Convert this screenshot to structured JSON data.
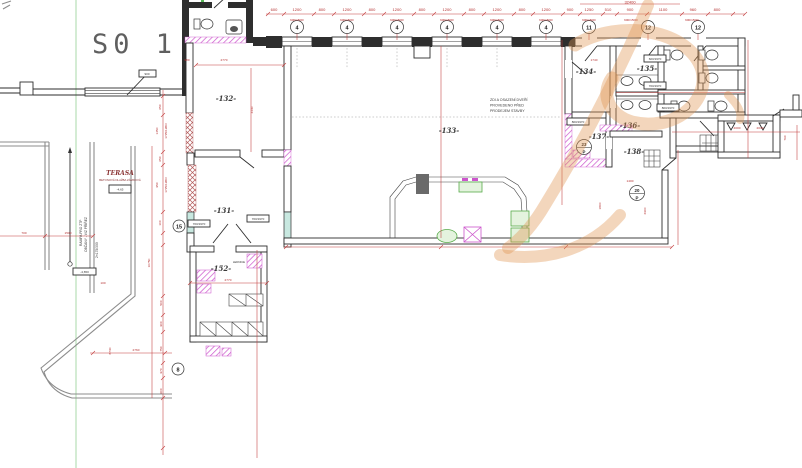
{
  "title": "S0 1",
  "axes": [
    "4",
    "4",
    "4",
    "4",
    "4",
    "4",
    "11",
    "12",
    "12"
  ],
  "rooms": {
    "r131": "-131-",
    "r132": "-132-",
    "r133": "-133-",
    "r134": "-134-",
    "r135": "-135-",
    "r136": "-136-",
    "r137": "-137-",
    "r138": "-138-",
    "r152": "-152-"
  },
  "markers": {
    "m15": "15",
    "m8": "8",
    "m23": "23",
    "m23p": "P",
    "m20": "20",
    "m20p": "P"
  },
  "terasa": {
    "title": "TERASA",
    "subtitle": "BETONOVÁ DLAŽBA ZÁMKOVÁ",
    "elevation": "-4,65"
  },
  "notes": {
    "door1": "ZDI A OSAZENÍ DVEŘÍ",
    "door2": "PROVEDENO PŘED",
    "door3": "PRODEJEM STAVBY",
    "ramp1": "RAMPA PRO ZTP",
    "ramp2": "OBČANY - VIZ PŘÍŘEZ",
    "ramp3": "2×175/300",
    "lednice": "LEDNICE",
    "elev_low": "-4,650"
  },
  "colors": {
    "accent_red": "#c23b3b",
    "wall": "#2e2e2e",
    "magenta": "#cc55cc",
    "green": "#58ab4a",
    "watermark": "#e0934e",
    "window_teal": "#c8e8e0"
  },
  "dims": {
    "total": "32400",
    "top": [
      "600",
      "1200",
      "800",
      "1200",
      "800",
      "1200",
      "800",
      "1200",
      "800",
      "1200",
      "800",
      "1200",
      "900",
      "1250",
      "510",
      "900",
      "1100",
      "960",
      "800"
    ],
    "win": "600/1500/",
    "left": [
      "650",
      "1450",
      "650",
      "950",
      "100",
      "500",
      "900",
      "750",
      "970",
      "600"
    ],
    "left_sub": "1725/1980/",
    "d980": "980",
    "d2770a": "2770",
    "d4430": "4430",
    "d1740": "1740",
    "d2400": "2400",
    "d1400": "1400",
    "d2900": "2900",
    "d1800": "1800",
    "d2000": "2000",
    "d2030": "2030",
    "d760": "760",
    "d2770b": "2770",
    "d2760": "2760",
    "d8730": "8730",
    "d10750": "10750",
    "d700": "700",
    "d1500": "1500",
    "d100": "100",
    "d900": "900",
    "door_700": "700/1970",
    "door_600": "600/1970",
    "door_800": "800/1970"
  }
}
